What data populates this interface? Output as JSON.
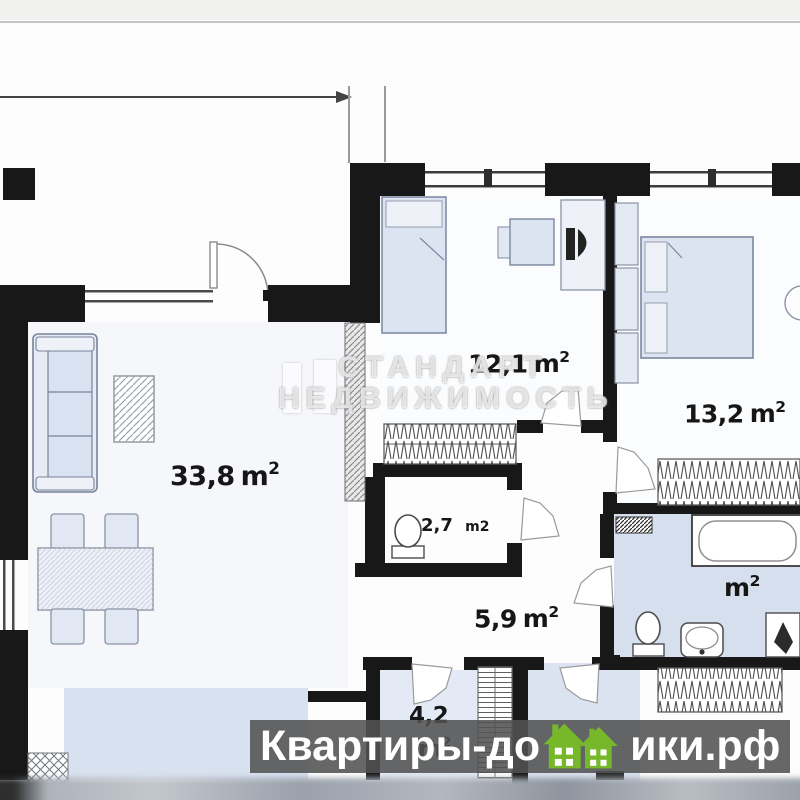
{
  "rooms": {
    "living": {
      "value": "33,8",
      "unit": "m",
      "sup": "2"
    },
    "bedroom1": {
      "value": "12,1",
      "unit": "m",
      "sup": "2"
    },
    "bedroom2": {
      "value": "13,2",
      "unit": "m",
      "sup": "2"
    },
    "wc": {
      "value": "2,7",
      "unit": "m2",
      "sup": ""
    },
    "hallway": {
      "value": "5,9",
      "unit": "m",
      "sup": "2"
    },
    "entry": {
      "value": "4,2",
      "unit": "m",
      "sup": "2"
    },
    "bathroom": {
      "value": "",
      "unit": "m",
      "sup": "2"
    }
  },
  "watermarks": {
    "center": {
      "line1": "СТАНДАРТ",
      "line2": "НЕДВИЖИМОСТЬ"
    },
    "banner": {
      "text_left": "Квартиры-до",
      "text_right": "ики.рф"
    }
  },
  "colors": {
    "wall": "#181818",
    "furniture_fill": "#dce4f2",
    "floor_blue": "#d6dfee",
    "banner_bg": "#525252",
    "brand_green": "#76b82a"
  }
}
